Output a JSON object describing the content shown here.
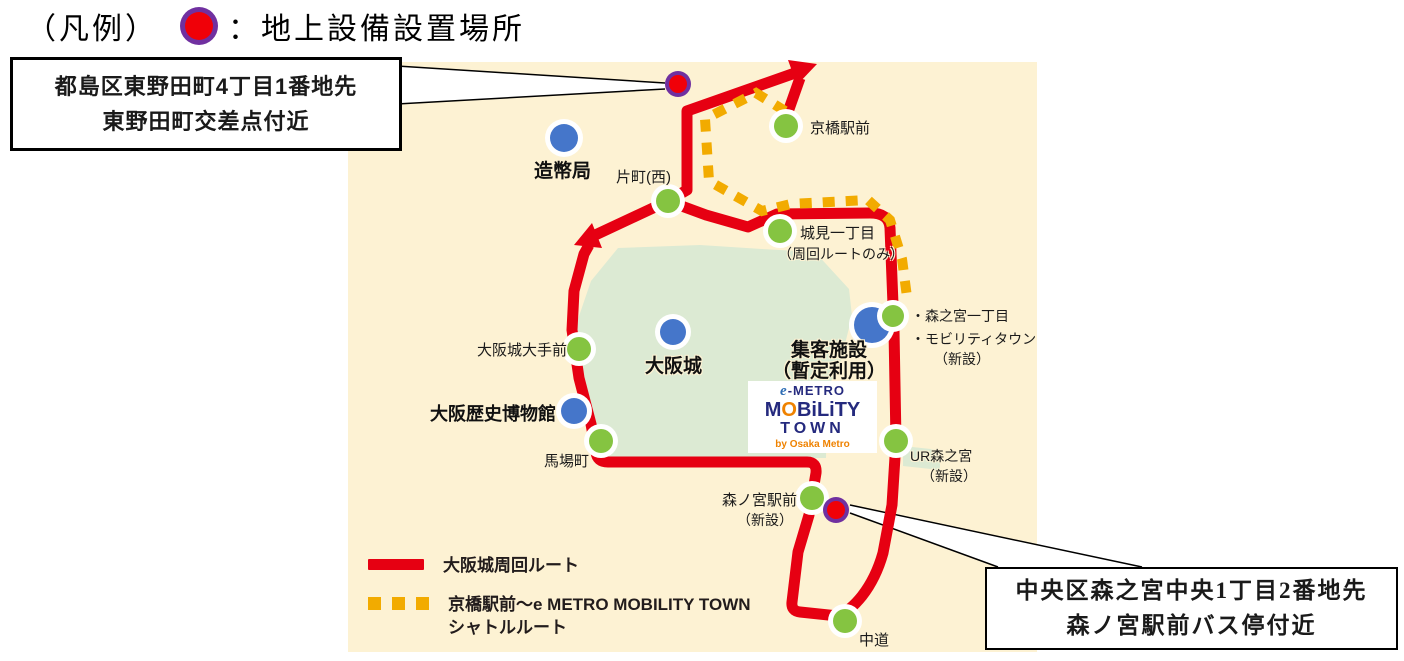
{
  "title": {
    "prefix": "（凡例）",
    "separator": "：",
    "label": "地上設備設置場所",
    "dot_icon": "ground-equipment-marker"
  },
  "callout_top": {
    "line1": "都島区東野田町4丁目1番地先",
    "line2": "東野田町交差点付近"
  },
  "callout_bottom": {
    "line1": "中央区森之宮中央1丁目2番地先",
    "line2": "森ノ宮駅前バス停付近"
  },
  "legend": {
    "loop_route": "大阪城周回ルート",
    "shuttle_route_line1": "京橋駅前～e METRO MOBILITY TOWN",
    "shuttle_route_line2": "シャトルルート"
  },
  "logo": {
    "e": "e",
    "metro": "-METRO",
    "m": "M",
    "o": "O",
    "bility": "BiLiTY",
    "town": "TOWN",
    "by": "by Osaka Metro"
  },
  "map": {
    "stops": {
      "kyobashi": "京橋駅前",
      "katamachi": "片町(西)",
      "shiromi": "城見一丁目",
      "shiromi_note": "（周回ルートのみ）",
      "otemae": "大阪城大手前",
      "babacho": "馬場町",
      "morinomiya_ekimae": "森ノ宮駅前",
      "morinomiya_ekimae_note": "（新設）",
      "nakamichi": "中道",
      "ur_morinomiya": "UR森之宮",
      "ur_morinomiya_note": "（新設）",
      "morinomiya_itchome": "・森之宮一丁目",
      "mobility_town": "・モビリティタウン",
      "mobility_town_note": "（新設）"
    },
    "facilities": {
      "mint": "造幣局",
      "osaka_castle": "大阪城",
      "museum": "大阪歴史博物館",
      "visitor_facility": "集客施設",
      "visitor_facility_note": "（暫定利用）"
    }
  },
  "colors": {
    "map_background": "#fdf2d3",
    "park_green": "#dcead3",
    "loop_route_red": "#e60012",
    "shuttle_yellow": "#f2ab00",
    "stop_green": "#85c441",
    "facility_blue": "#4576ca",
    "equipment_ring_purple": "#7030a0",
    "equipment_dot_red": "#f00008",
    "logo_navy": "#252a7e",
    "logo_orange": "#ef8200"
  }
}
